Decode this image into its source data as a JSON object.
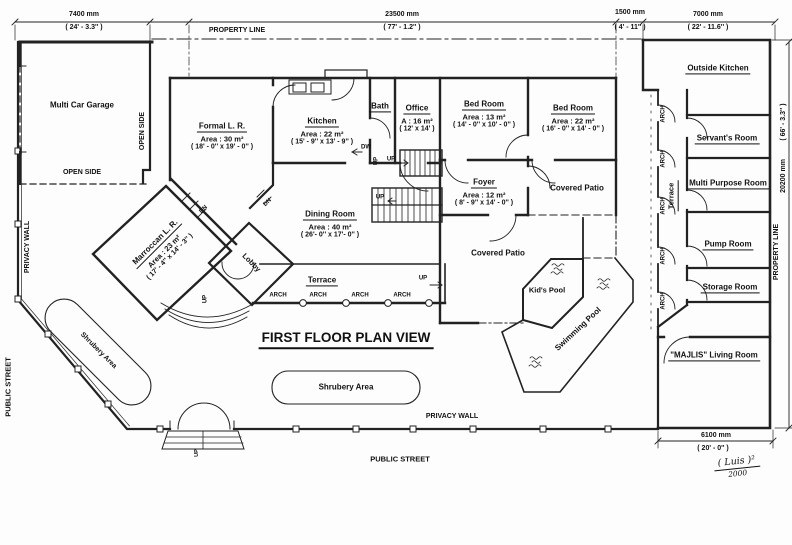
{
  "title": "FIRST FLOOR PLAN VIEW",
  "dimensions": {
    "d7400": {
      "mm": "7400  mm",
      "ft": "( 24' - 3.3'' )"
    },
    "d23500": {
      "mm": "23500  mm",
      "ft": "( 77' - 1.2'' )"
    },
    "d1500": {
      "mm": "1500  mm",
      "ft": "( 4' - 11'' )"
    },
    "d7000": {
      "mm": "7000  mm",
      "ft": "( 22' - 11.6'' )"
    },
    "d20200": {
      "mm": "20200  mm",
      "ft": "( 66' - 3.3'' )"
    },
    "d6100": {
      "mm": "6100  mm",
      "ft": "( 20' - 0'' )"
    }
  },
  "boundaries": {
    "property_line": "PROPERTY LINE",
    "privacy_wall": "PRIVACY WALL",
    "public_street": "PUBLIC STREET",
    "open_side": "OPEN SIDE"
  },
  "rooms": {
    "garage": {
      "name": "Multi Car Garage"
    },
    "formal_lr": {
      "name": "Formal L. R.",
      "area": "Area : 30 m²",
      "dims": "( 18' - 0'' x 19' - 0'' )"
    },
    "kitchen": {
      "name": "Kitchen",
      "area": "Area : 22 m²",
      "dims": "( 15' - 9'' x 13' - 9'' )"
    },
    "bath": {
      "name": "Bath"
    },
    "office": {
      "name": "Office",
      "area": "A : 16 m²",
      "dims": "( 12' x 14' )"
    },
    "bedroom1": {
      "name": "Bed Room",
      "area": "Area : 13 m²",
      "dims": "( 14' - 0'' x 10' - 0'' )"
    },
    "bedroom2": {
      "name": "Bed Room",
      "area": "Area : 22 m²",
      "dims": "( 16' - 0'' x 14' - 0'' )"
    },
    "foyer": {
      "name": "Foyer",
      "area": "Area : 12 m²",
      "dims": "( 8' - 9'' x 14' - 0'' )"
    },
    "dining": {
      "name": "Dining Room",
      "area": "Area : 40 m²",
      "dims": "( 26'- 0'' x 17'- 0'' )"
    },
    "marroccan": {
      "name": "Marroccan L. R.",
      "area": "Area : 23 m²",
      "dims": "( 17' - 4'' x 14' - 3'' )"
    },
    "lobby": {
      "name": "Lobby"
    },
    "covered_patio": {
      "name": "Covered Patio"
    },
    "terrace": {
      "name": "Terrace"
    },
    "kids_pool": {
      "name": "Kid's Pool"
    },
    "swimming_pool": {
      "name": "Swimming Pool"
    },
    "shrubery": {
      "name": "Shrubery Area"
    },
    "outside_kitchen": {
      "name": "Outside Kitchen"
    },
    "servants": {
      "name": "Servant's Room"
    },
    "multipurpose": {
      "name": "Multi Purpose Room"
    },
    "pump": {
      "name": "Pump Room"
    },
    "storage": {
      "name": "Storage Room"
    },
    "majlis": {
      "name": "\"MAJLIS\" Living Room"
    }
  },
  "labels": {
    "arch": "ARCH",
    "up": "UP",
    "dn": "DN",
    "dw": "DW"
  },
  "signature": {
    "line1": "( Luis )²",
    "line2": "2000"
  }
}
